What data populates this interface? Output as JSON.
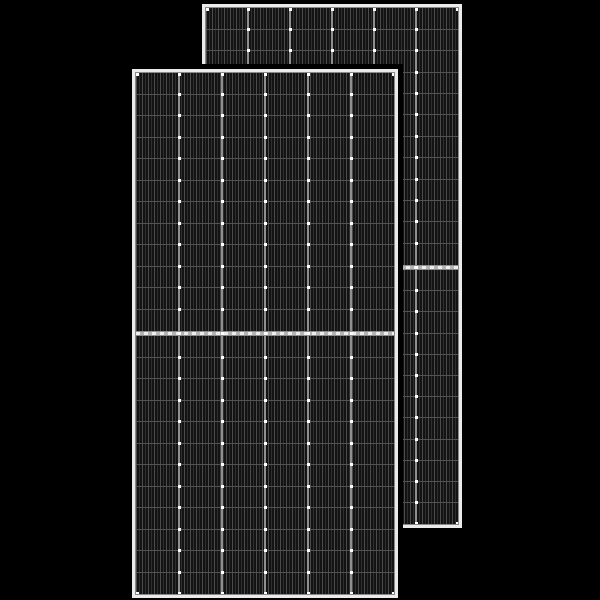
{
  "scene": {
    "width": 600,
    "height": 600,
    "background": "#000000",
    "subject": "two-black-framed-half-cut-solar-panels"
  },
  "colors": {
    "background": "#000000",
    "frame": "#ebebeb",
    "frame_edge": "#8a8a8a",
    "cell_base": "#131313",
    "finger_bright": "#4c4c4c",
    "finger_dim": "#2e2e2e",
    "column_divider": "#8f8f8f",
    "row_line": "#525252",
    "mid_band_bright": "#ededed",
    "mid_band_dim": "#b5b5b5",
    "mid_band_edge": "#8d8d8d",
    "solder_dot": "#ffffff",
    "overlap_shadow": "#000000"
  },
  "panels": [
    {
      "name": "solar-panel-back",
      "x": 202,
      "y": 4,
      "width": 260,
      "height": 524,
      "frame_px": 4,
      "columns": 6,
      "rows_per_half": 12,
      "mid_y": 263,
      "gap_band_height": 5,
      "outline_px": 0
    },
    {
      "name": "solar-panel-front",
      "x": 132,
      "y": 69,
      "width": 266,
      "height": 529,
      "frame_px": 4,
      "columns": 6,
      "rows_per_half": 12,
      "mid_y": 264,
      "gap_band_height": 5,
      "outline_px": 5
    }
  ]
}
